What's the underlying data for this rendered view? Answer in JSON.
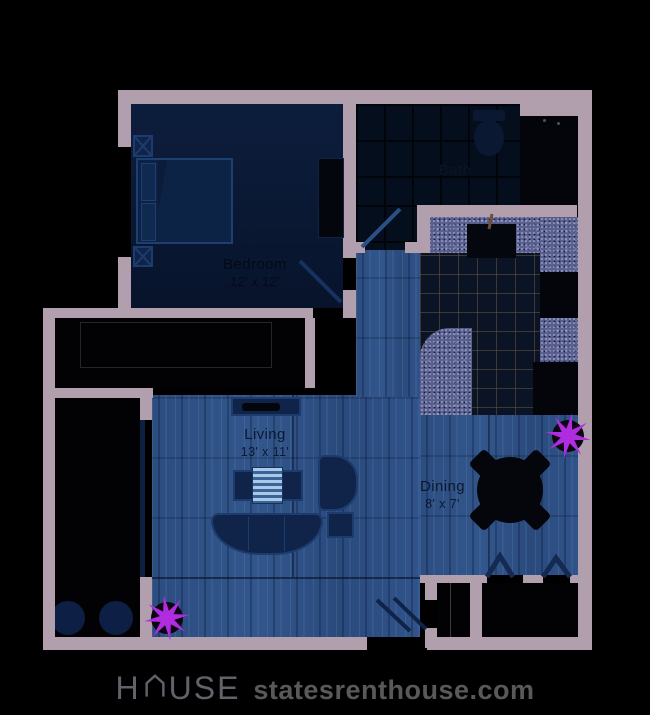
{
  "rooms": {
    "bedroom": {
      "name": "Bedroom",
      "dims": "12' x 12'"
    },
    "living": {
      "name": "Living",
      "dims": "13' x 11'"
    },
    "dining": {
      "name": "Dining",
      "dims": "8' x 7'"
    },
    "bath": {
      "name": "Bath"
    }
  },
  "watermark": {
    "brand_prefix": "H",
    "brand_suffix": "USE",
    "site": "statesrenthouse.com"
  },
  "markers": {
    "count": 2,
    "description": "purple 8-point star markers",
    "color": "#b02ce0"
  },
  "colors": {
    "background": "#000000",
    "walls": "#b19fad",
    "wood_floor": "#2f5286",
    "bedroom_floor": "#0a1a36",
    "kitchen_counter": "#596090",
    "furniture_navy": "#0f2448",
    "star": "#b02ce0"
  }
}
